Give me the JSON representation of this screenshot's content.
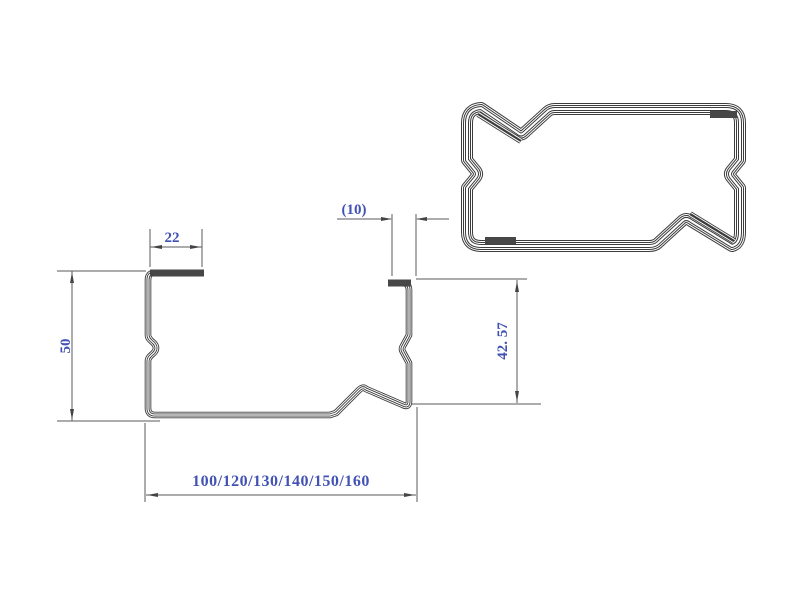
{
  "page": {
    "background": "#ffffff",
    "description": "CAD cross-section drawing of a cold-formed steel C-channel purlin profile with an interlocked double-profile box view"
  },
  "drawing": {
    "colors": {
      "outline": "#3c3c3c",
      "dimension_line": "#5a5a5a",
      "label_text": "#4152b4",
      "lip_bar": "#474747"
    },
    "labels": {
      "top_lip_width": "22",
      "web_height": "50",
      "right_lip_width": "(10)",
      "right_height": "42. 57",
      "bottom_width_options": "100/120/130/140/150/160"
    }
  }
}
